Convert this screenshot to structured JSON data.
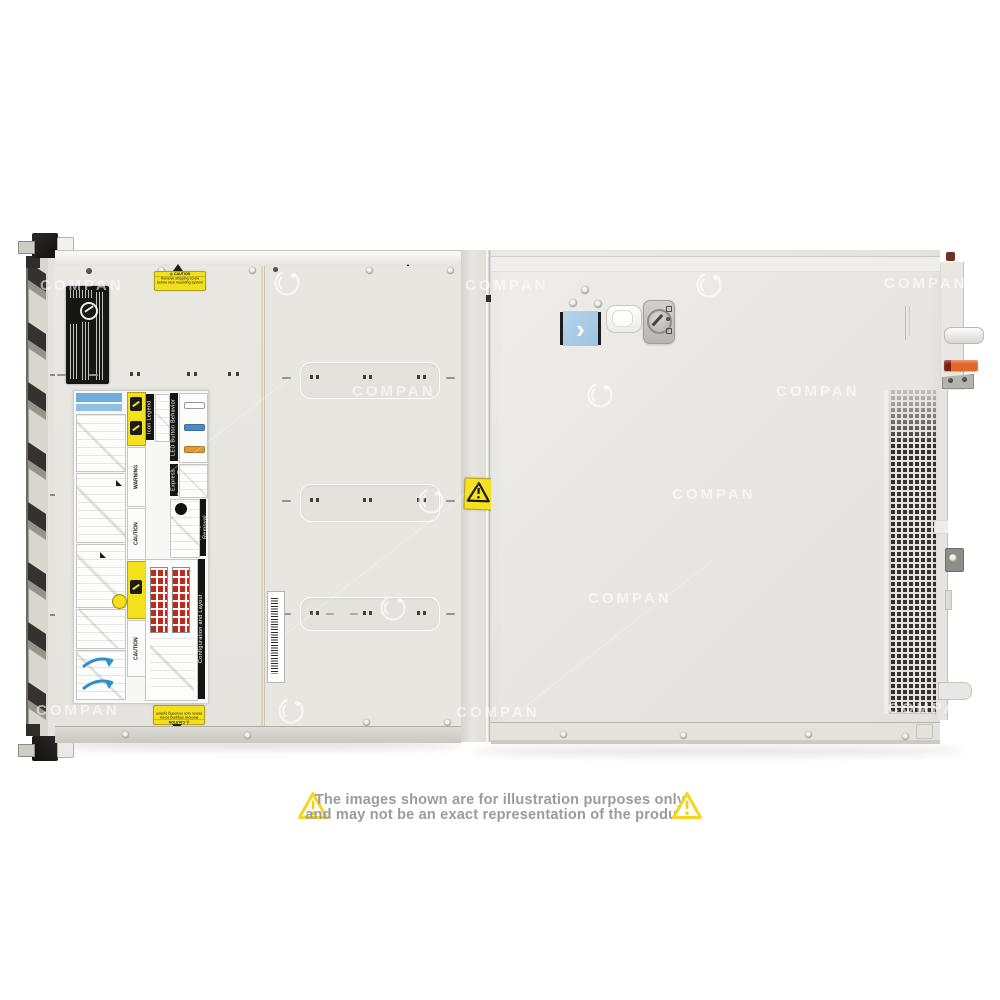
{
  "watermark": {
    "text": "COMPAN"
  },
  "server": {
    "caution_sticker": {
      "title": "⚠ CAUTION",
      "line1": "Remove shipping screw",
      "line2": "before rack mounting system"
    },
    "service_panel": {
      "warning": "WARNING",
      "caution": "CAUTION",
      "icon_legend": "Icon Legend",
      "led": "LED Button Behavior",
      "service_tag": "Rear Express Service Tag",
      "shipping": "Shipping Screw Removal",
      "config": "Configuration and Layout"
    },
    "cover_sticker_chevron": "›"
  },
  "disclaimer": {
    "line1": "The images shown are for illustration purposes only",
    "line2": "and may not be an exact representation of the product."
  },
  "colors": {
    "caution_yellow": "#f2df1d",
    "triangle_yellow": "#f6d41f",
    "text_gray": "#9b9b9b",
    "sticker_blue": "#a9cbe7",
    "led_blue": "#4a8cc8",
    "led_orange": "#e0993a",
    "lever_orange": "#e2672b",
    "red_grid": "#c0281e"
  }
}
